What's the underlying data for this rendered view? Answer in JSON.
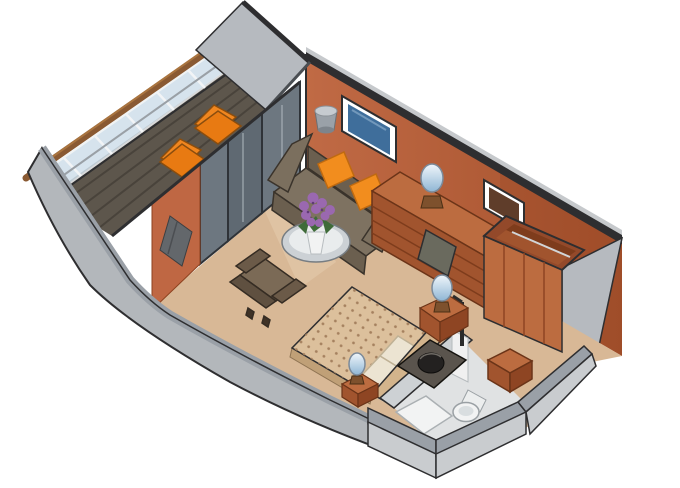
{
  "scene": {
    "type": "isometric-floorplan",
    "subject": "cruise-ship stateroom with private veranda",
    "areas": [
      {
        "name": "veranda",
        "items": [
          "privacy-partition",
          "railing-glass",
          "wood-handrail",
          "deck-planks",
          "lounger",
          "lounger"
        ]
      },
      {
        "name": "living-area",
        "items": [
          "sliding-glass-doors",
          "curtain",
          "flat-tv",
          "wall-sconce",
          "sofa",
          "throw-pillow",
          "throw-pillow",
          "glass-coffee-table",
          "flower-bouquet",
          "armchair"
        ]
      },
      {
        "name": "dressing-area",
        "items": [
          "dresser-desk",
          "desk-chair",
          "table-lamp",
          "wall-mirror",
          "wardrobe"
        ]
      },
      {
        "name": "sleeping-area",
        "items": [
          "double-bed",
          "bed-pillows",
          "headboard",
          "nightstand",
          "table-lamp",
          "nightstand",
          "table-lamp"
        ]
      },
      {
        "name": "bathroom",
        "items": [
          "vanity-sink",
          "toilet",
          "shower",
          "door-panel",
          "storage-cube",
          "towel-pole"
        ]
      },
      {
        "name": "structure",
        "items": [
          "curved-hull-wall",
          "back-wall",
          "right-wall",
          "outer-walls",
          "carpet-floor"
        ]
      }
    ]
  },
  "palette": {
    "outline": "#2e2e30",
    "wall_gray": "#b6babf",
    "hull_face": "#b3b7bb",
    "hull_top": "#9aa0a7",
    "hull_light": "#c9cccf",
    "wall_orange": "#bf6743",
    "wall_orange_dark": "#8e421f",
    "wood": "#bc6c40",
    "wood_dark": "#a1542e",
    "wood_deep": "#8e4523",
    "handrail": "#8a5a33",
    "glass": "#cfdfeb",
    "deck": "#5d564c",
    "deck_slat": "#49433b",
    "lounger": "#f0861f",
    "carpet": "#d8b896",
    "carpet_light": "#e3c9ab",
    "sofa": "#7e7261",
    "sofa_dark": "#6b5f4f",
    "pillow_orange": "#f28d1e",
    "tv_screen": "#3f6e9b",
    "door_glass": "#6d7780",
    "door_frame": "#2f3338",
    "curtain": "#63676b",
    "mirror": "#5f3d2a",
    "bedspread": "#dcc09c",
    "bed_dot": "#a5815f",
    "pillow_cream": "#ece4d2",
    "headboard": "#d3b48c",
    "chair_brown": "#7b6a56",
    "chair_dark": "#5f5040",
    "flower": "#9a68b0",
    "leaf": "#3f6b39",
    "vanity": "#5a544d",
    "sink": "#232120",
    "fixture_white": "#f2f3f3",
    "bath_floor": "#e0e2e3",
    "lamp_base": "#7e512d"
  },
  "canvas": {
    "width": 680,
    "height": 488,
    "background": "#ffffff"
  }
}
